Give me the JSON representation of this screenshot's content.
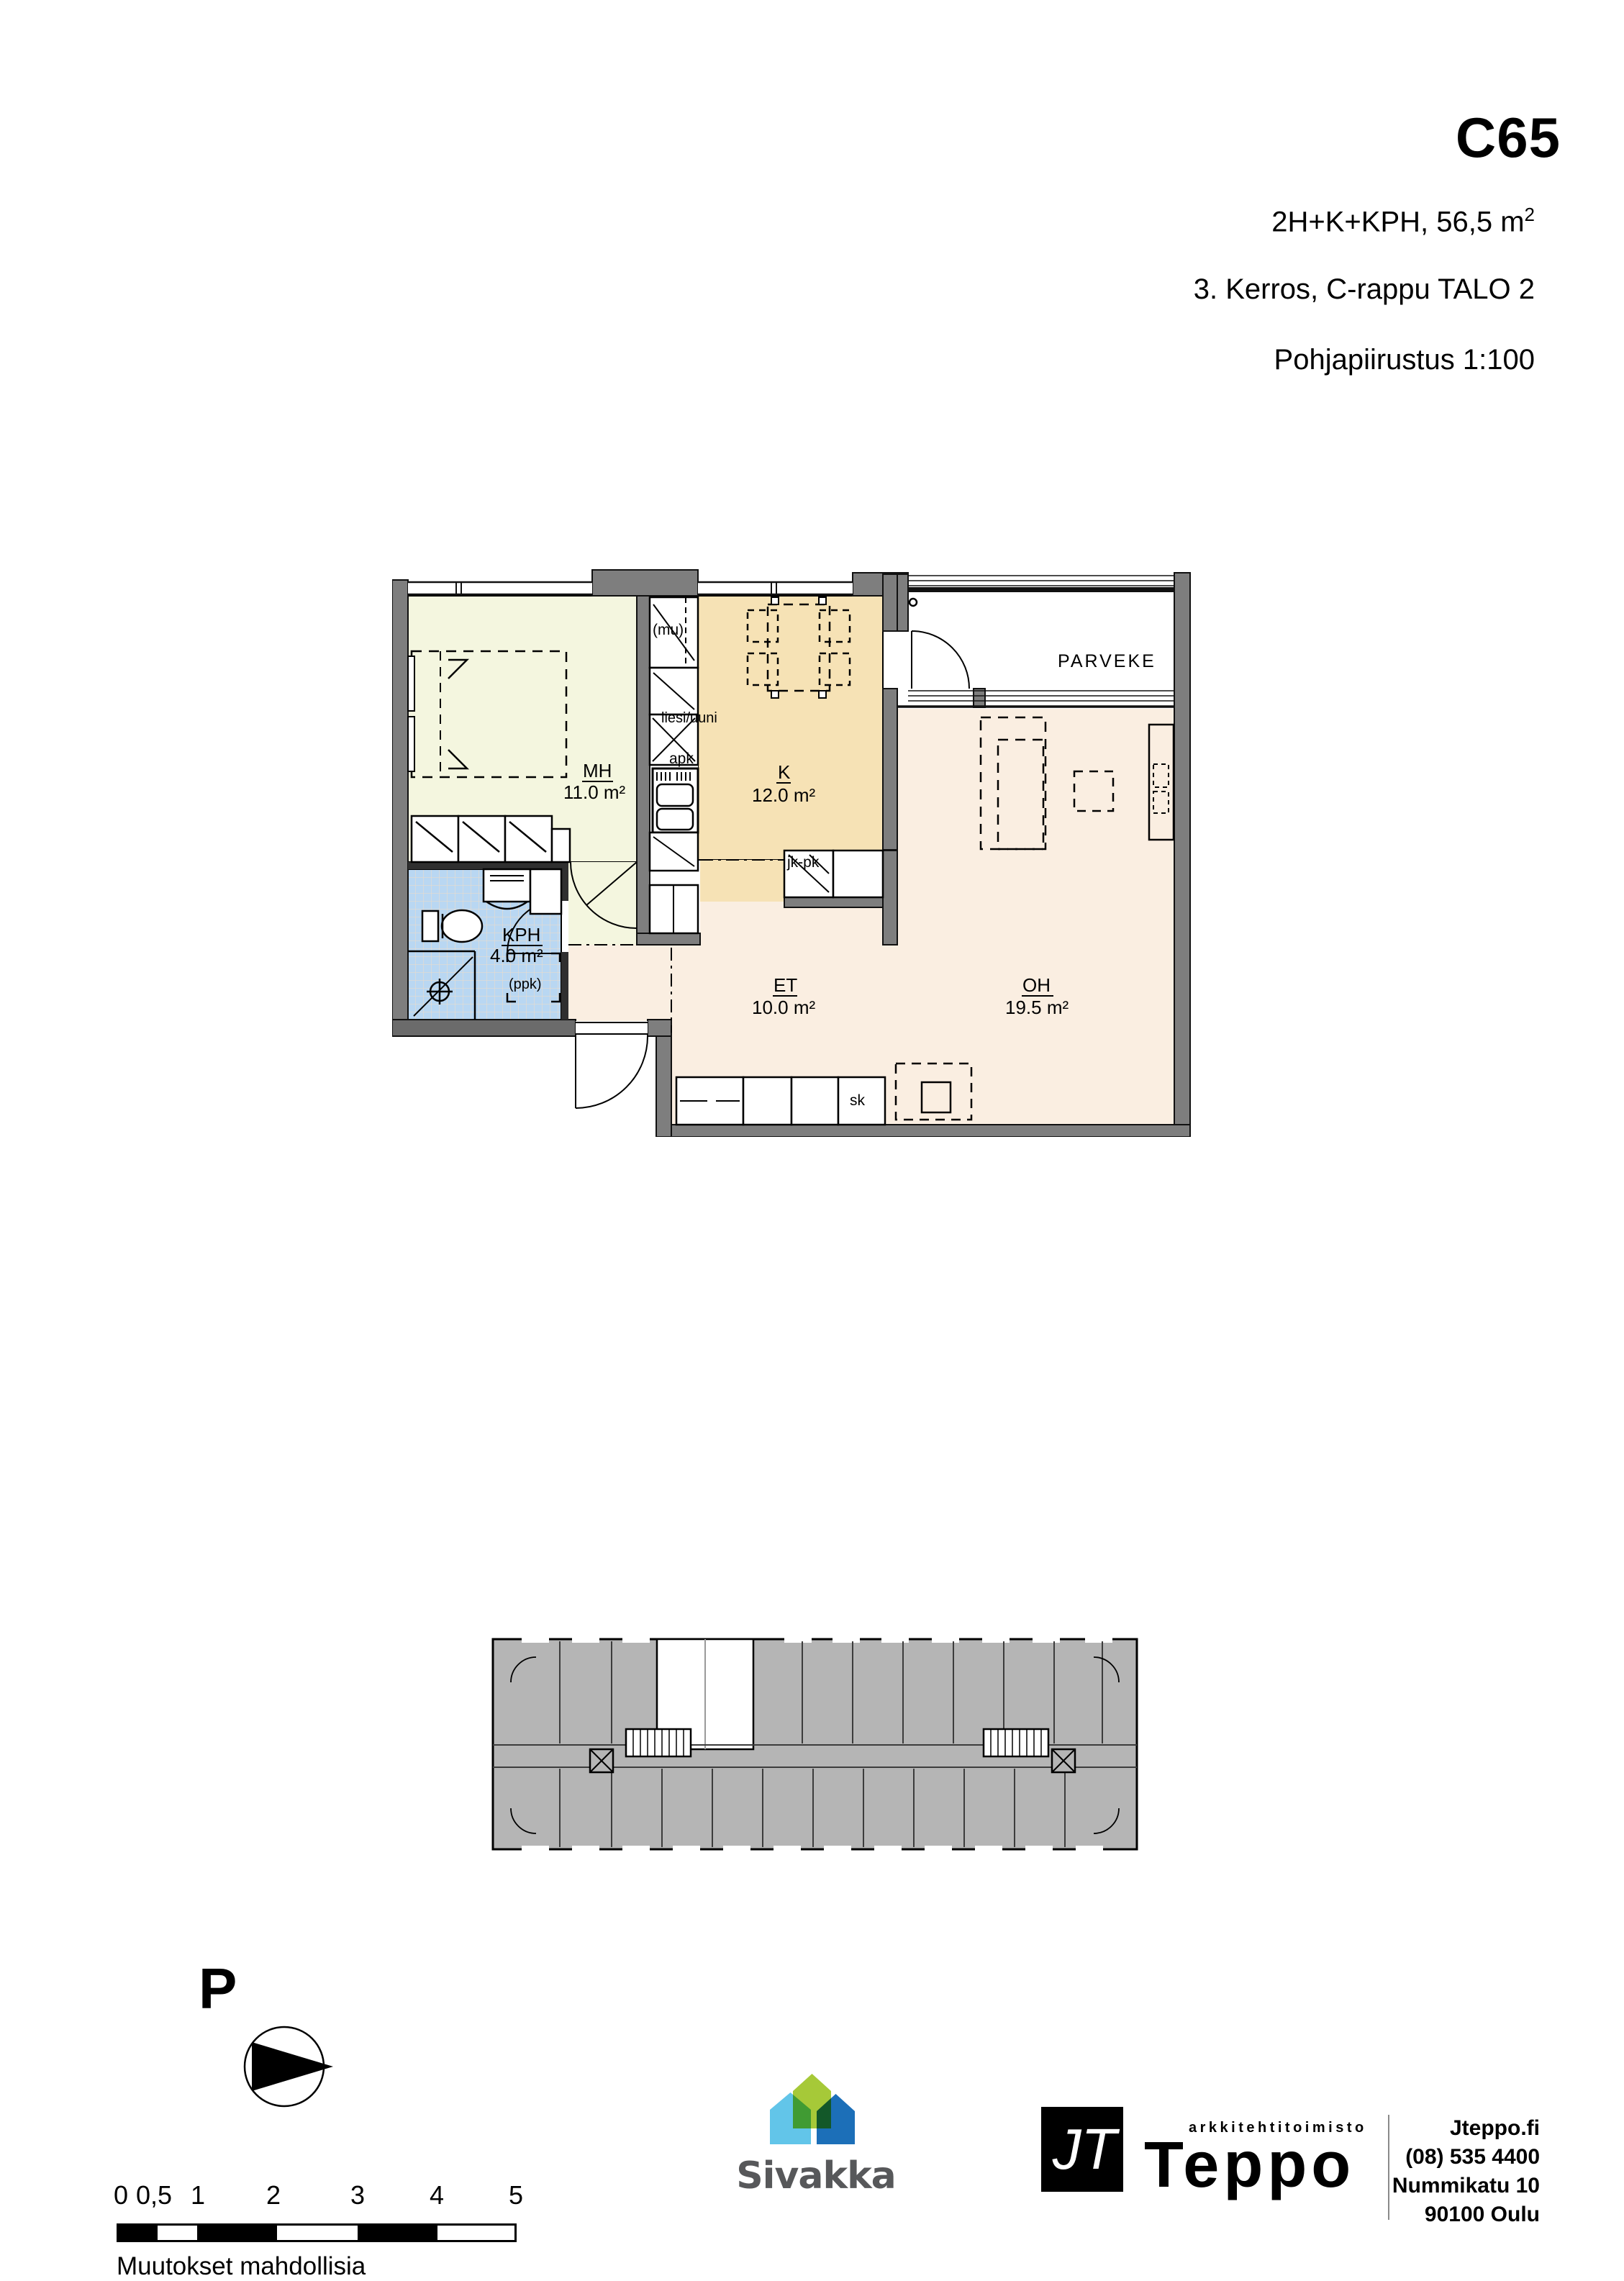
{
  "header": {
    "apartment_id": "C65",
    "spec": "2H+K+KPH, 56,5  m",
    "spec_sup": "2",
    "floor_info": "3. Kerros, C-rappu TALO 2",
    "drawing_title": "Pohjapiirustus 1:100"
  },
  "plan": {
    "balcony_label": "PARVEKE",
    "rooms": {
      "mh": {
        "name": "MH",
        "area": "11.0 m²"
      },
      "k": {
        "name": "K",
        "area": "12.0 m²"
      },
      "kph": {
        "name": "KPH",
        "area": "4.0 m²"
      },
      "et": {
        "name": "ET",
        "area": "10.0 m²"
      },
      "oh": {
        "name": "OH",
        "area": "19.5 m²"
      }
    },
    "fixtures": {
      "microwave": "(mu)",
      "stove_oven": "liesi/uuni",
      "dishwasher": "apk",
      "fridge_freezer": "jk-pk",
      "washer_reservation": "(ppk)",
      "cleaning_closet": "sk"
    },
    "colors": {
      "wall": "#7e7e7e",
      "bedroom": "#f4f6df",
      "kitchen": "#f6e2b5",
      "hall_living": "#faeee1",
      "bathroom": "#b9d7f2",
      "overview_gray": "#b5b5b5"
    }
  },
  "north": {
    "label": "P"
  },
  "scale_bar": {
    "ticks": [
      "0",
      "0,5",
      "1",
      "2",
      "3",
      "4",
      "5"
    ],
    "note": "Muutokset mahdollisia"
  },
  "logos": {
    "sivakka": {
      "wordmark": "Sivakka",
      "colors": {
        "light_blue": "#62c5e9",
        "lime": "#a6c938",
        "dark_blue": "#1c6fb8"
      }
    },
    "teppo": {
      "monogram": "JT",
      "office_type": "arkkitehtitoimisto",
      "office_name": "Teppo",
      "website": "Jteppo.fi",
      "phone": "(08) 535 4400",
      "street": "Nummikatu 10",
      "city": "90100 Oulu"
    }
  }
}
